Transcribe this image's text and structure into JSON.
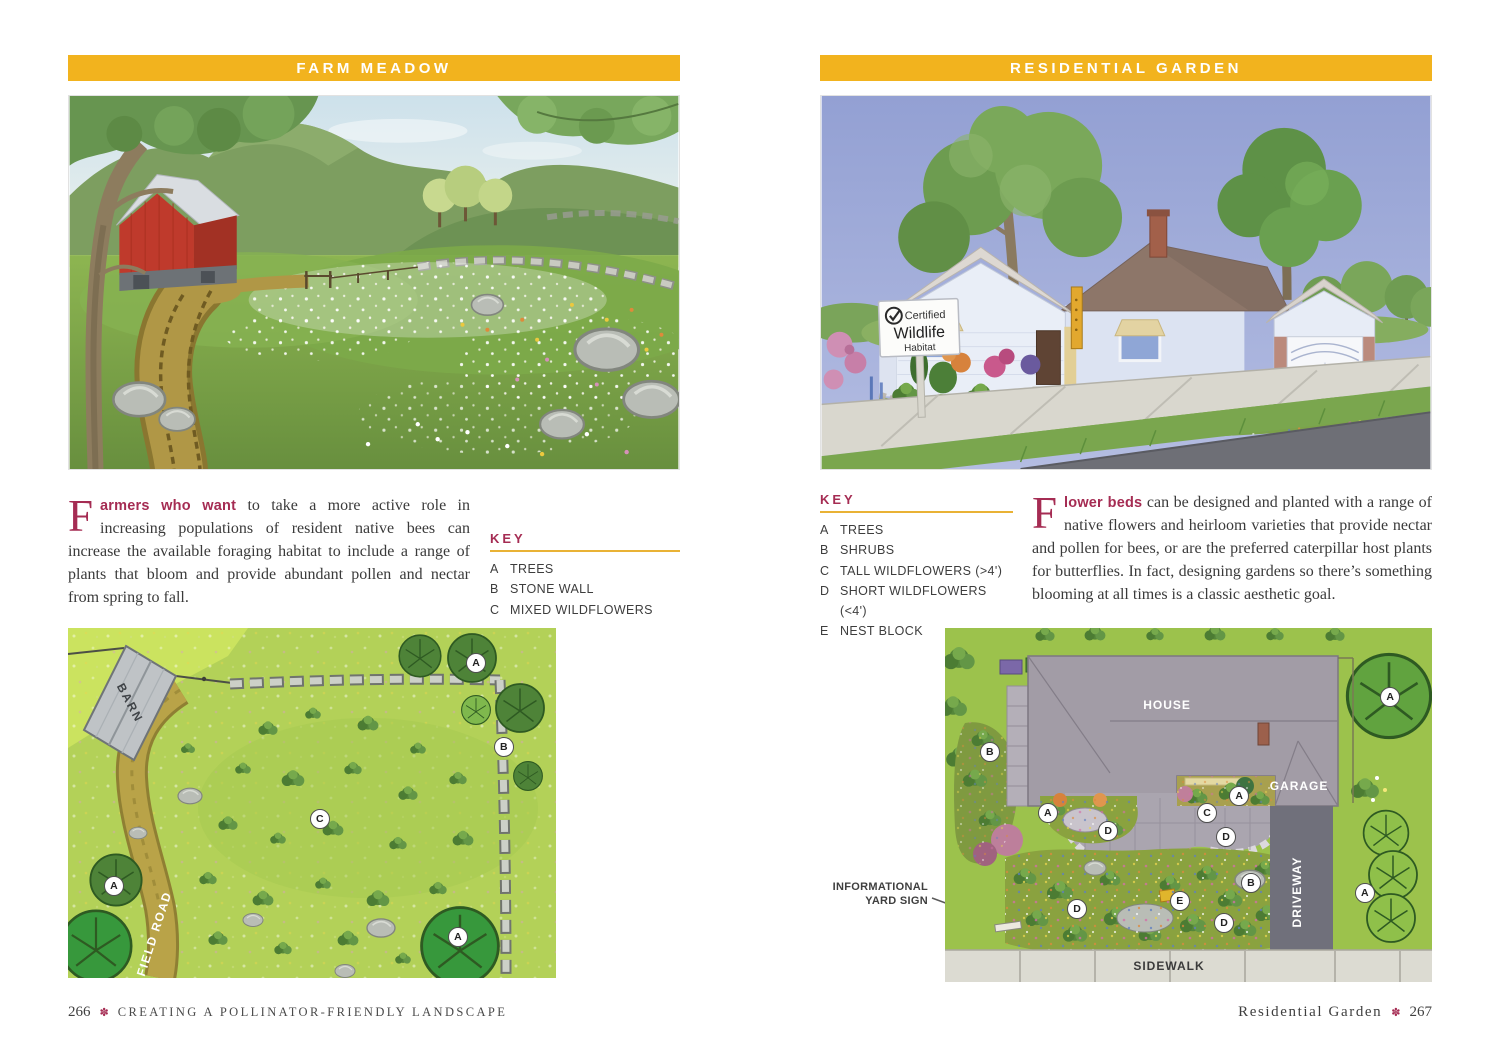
{
  "colors": {
    "header_bar": "#f2b31e",
    "accent_maroon": "#a52c53",
    "body_text": "#3a3a3a",
    "key_underline": "#e9b235"
  },
  "left_page": {
    "header": "FARM MEADOW",
    "intro": {
      "drop_cap": "F",
      "lead": "armers who want",
      "body": " to take a more active role in increasing populations of resident native bees can increase the available foraging habitat to include a range of plants that bloom and provide abundant pollen and nectar from spring to fall."
    },
    "key": {
      "title": "KEY",
      "items": [
        {
          "letter": "A",
          "label": "TREES"
        },
        {
          "letter": "B",
          "label": "STONE WALL"
        },
        {
          "letter": "C",
          "label": "MIXED WILDFLOWERS"
        }
      ]
    },
    "plan": {
      "barn_label": "BARN",
      "road_label": "FIELD ROAD",
      "markers": [
        {
          "letter": "A",
          "x": 83.4,
          "y": 9.7
        },
        {
          "letter": "B",
          "x": 89.1,
          "y": 33.7
        },
        {
          "letter": "C",
          "x": 51.4,
          "y": 54.3
        },
        {
          "letter": "A",
          "x": 9.2,
          "y": 73.4
        },
        {
          "letter": "A",
          "x": 79.7,
          "y": 88.0
        }
      ]
    },
    "footer": {
      "page_number": "266",
      "flower": "✽",
      "text": "CREATING A POLLINATOR-FRIENDLY LANDSCAPE"
    }
  },
  "right_page": {
    "header": "RESIDENTIAL GARDEN",
    "key": {
      "title": "KEY",
      "items": [
        {
          "letter": "A",
          "label": "TREES"
        },
        {
          "letter": "B",
          "label": "SHRUBS"
        },
        {
          "letter": "C",
          "label": "TALL WILDFLOWERS (>4')"
        },
        {
          "letter": "D",
          "label": "SHORT WILDFLOWERS (<4')"
        },
        {
          "letter": "E",
          "label": "NEST BLOCK"
        }
      ]
    },
    "intro": {
      "drop_cap": "F",
      "lead": "lower beds",
      "body": " can be designed and planted with a range of native flowers and heirloom varieties that provide nectar and pollen for bees, or are the preferred caterpillar host plants for butterflies. In fact, designing gardens so there’s something blooming at all times is a classic aesthetic goal."
    },
    "illustration": {
      "sign_check": "✓",
      "sign_line1": "Certified",
      "sign_line2": "Wildlife",
      "sign_line3": "Habitat"
    },
    "plan": {
      "house_label": "HOUSE",
      "garage_label": "GARAGE",
      "driveway_label": "DRIVEWAY",
      "sidewalk_label": "SIDEWALK",
      "annotation_line1": "INFORMATIONAL",
      "annotation_line2": "YARD SIGN",
      "markers": [
        {
          "letter": "A",
          "x": 91.2,
          "y": 19.2
        },
        {
          "letter": "B",
          "x": 9.0,
          "y": 34.7
        },
        {
          "letter": "A",
          "x": 20.9,
          "y": 52.0
        },
        {
          "letter": "D",
          "x": 33.3,
          "y": 57.1
        },
        {
          "letter": "C",
          "x": 53.6,
          "y": 52.0
        },
        {
          "letter": "A",
          "x": 60.2,
          "y": 47.2
        },
        {
          "letter": "D",
          "x": 57.5,
          "y": 58.8
        },
        {
          "letter": "B",
          "x": 62.6,
          "y": 71.8
        },
        {
          "letter": "E",
          "x": 48.0,
          "y": 76.8
        },
        {
          "letter": "D",
          "x": 26.9,
          "y": 79.1
        },
        {
          "letter": "D",
          "x": 57.1,
          "y": 83.1
        },
        {
          "letter": "A",
          "x": 86.0,
          "y": 74.6
        }
      ]
    },
    "footer": {
      "text": "Residential Garden",
      "flower": "✽",
      "page_number": "267"
    }
  }
}
